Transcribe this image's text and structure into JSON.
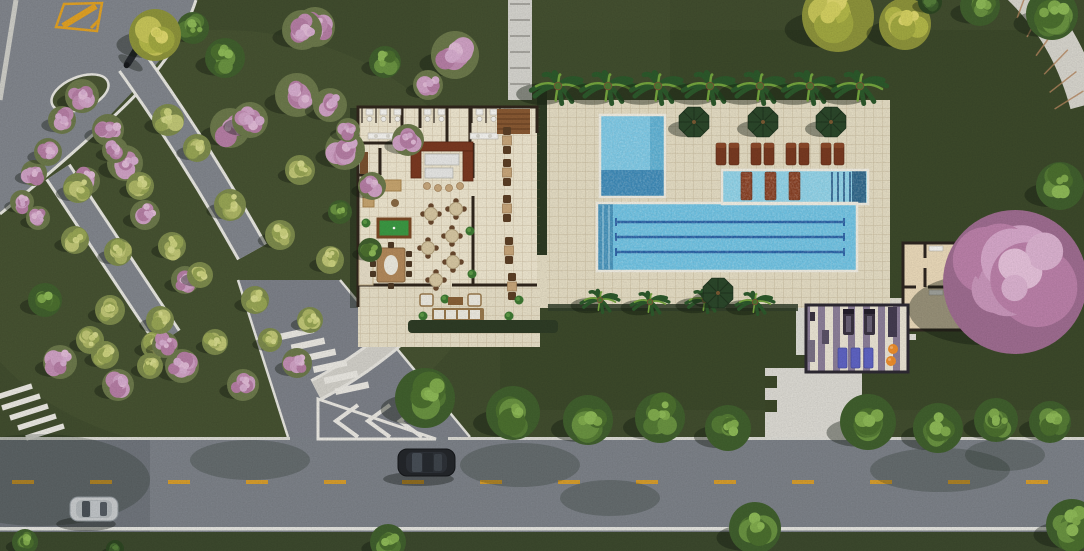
{
  "scene": {
    "description": "Aerial 3D-rendered site plan of a residential club amenity area: clubhouse with bar and games room, square children's pool, 3-lane lap pool with tanning shelf, fitness room, pool restrooms, palm-lined paver deck, flowering-tree grove with parking aisles, and a two-lane street with cars",
    "width": 1084,
    "height": 551
  },
  "areas": {
    "clubhouse": "clubhouse floor plan",
    "kids_pool": "children's pool",
    "lap_pool": "lap pool",
    "sun_shelf": "tanning shelf",
    "gym": "fitness room",
    "restrooms": "pool restrooms",
    "street": "two-lane street",
    "grove": "flowering tree grove"
  },
  "palette": {
    "grass": "#424e2f",
    "grass_dark": "#3c4829",
    "grass_light": "#4d5a37",
    "asphalt": "#7e838a",
    "curb": "#e9e8e2",
    "sidewalk": "#d7d6d0",
    "deck": "#e7dfc6",
    "floor": "#f0e8d1",
    "wall": "#31271d",
    "water": "#6fc4e5",
    "water_light": "#8fd4ea",
    "water_dark": "#3f8cba",
    "lane": "#2a63a8",
    "coping": "#f3f0e5",
    "umbrella": "#2c482b",
    "lounger": "#7a3b22",
    "hedge": "#2e3b24",
    "marking_yellow": "#dd9f28",
    "marking_white": "#eceae4",
    "gym_floor_a": "#ece6d6",
    "gym_floor_b": "#8e819b",
    "mat_blue": "#6065c6",
    "ball_orange": "#ef8f2d",
    "car_dark": "#24272b",
    "car_silver": "#c9ccce",
    "palm_dark": "#2d5a2c",
    "palm_light": "#76a73f",
    "pink_tree": "#d1a3c6",
    "yellow_tree": "#c9c75a",
    "green_tree": "#6b9442"
  },
  "trees": {
    "grove": [
      [
        "p",
        82,
        96,
        17
      ],
      [
        "p",
        62,
        120,
        14
      ],
      [
        "p",
        108,
        130,
        16
      ],
      [
        "p",
        125,
        163,
        18
      ],
      [
        "p",
        86,
        181,
        14
      ],
      [
        "p",
        34,
        173,
        13
      ],
      [
        "p",
        22,
        202,
        12
      ],
      [
        "p",
        230,
        128,
        20
      ],
      [
        "p",
        297,
        95,
        22
      ],
      [
        "p",
        345,
        150,
        20
      ],
      [
        "p",
        315,
        27,
        20
      ],
      [
        "p",
        48,
        152,
        14
      ],
      [
        "p",
        115,
        150,
        13
      ],
      [
        "p",
        145,
        215,
        15
      ],
      [
        "p",
        38,
        218,
        12
      ],
      [
        "p",
        185,
        280,
        14
      ],
      [
        "p",
        165,
        345,
        13
      ],
      [
        "p",
        408,
        140,
        16
      ],
      [
        "p",
        372,
        186,
        14
      ],
      [
        "p",
        455,
        55,
        24
      ],
      [
        "p",
        348,
        130,
        12
      ],
      [
        "p",
        250,
        120,
        18
      ],
      [
        "p",
        330,
        105,
        17
      ],
      [
        "p",
        302,
        30,
        20
      ],
      [
        "p",
        428,
        85,
        15
      ],
      [
        "yg",
        168,
        120,
        16
      ],
      [
        "yg",
        197,
        148,
        14
      ],
      [
        "yg",
        78,
        188,
        15
      ],
      [
        "yg",
        140,
        186,
        14
      ],
      [
        "yg",
        75,
        240,
        14
      ],
      [
        "yg",
        118,
        252,
        14
      ],
      [
        "yg",
        172,
        246,
        14
      ],
      [
        "yg",
        110,
        310,
        15
      ],
      [
        "yg",
        160,
        320,
        14
      ],
      [
        "yg",
        105,
        355,
        14
      ],
      [
        "yg",
        150,
        366,
        13
      ],
      [
        "yg",
        230,
        205,
        16
      ],
      [
        "yg",
        280,
        235,
        15
      ],
      [
        "yg",
        300,
        170,
        15
      ],
      [
        "yg",
        330,
        260,
        14
      ],
      [
        "yg",
        255,
        300,
        14
      ],
      [
        "yg",
        200,
        275,
        13
      ],
      [
        "yg",
        310,
        320,
        13
      ],
      [
        "g",
        225,
        58,
        20
      ],
      [
        "g",
        45,
        300,
        17
      ],
      [
        "g",
        193,
        28,
        16
      ],
      [
        "g",
        385,
        62,
        16
      ],
      [
        "g",
        340,
        212,
        12
      ],
      [
        "g",
        370,
        250,
        12
      ],
      [
        "y",
        155,
        35,
        26
      ]
    ],
    "road_row": [
      [
        "p",
        60,
        362,
        17
      ],
      [
        "yg",
        90,
        340,
        14
      ],
      [
        "p",
        118,
        385,
        16
      ],
      [
        "yg",
        155,
        345,
        14
      ],
      [
        "p",
        182,
        366,
        17
      ],
      [
        "yg",
        215,
        342,
        13
      ],
      [
        "p",
        243,
        385,
        16
      ],
      [
        "yg",
        270,
        340,
        12
      ],
      [
        "p",
        297,
        363,
        15
      ]
    ],
    "street": [
      [
        "g",
        425,
        398,
        30
      ],
      [
        "g",
        513,
        413,
        27
      ],
      [
        "g",
        588,
        420,
        25
      ],
      [
        "g",
        660,
        418,
        25
      ],
      [
        "g",
        728,
        428,
        23
      ],
      [
        "g",
        868,
        422,
        28
      ],
      [
        "g",
        938,
        428,
        25
      ],
      [
        "g",
        996,
        420,
        22
      ],
      [
        "g",
        1050,
        422,
        21
      ]
    ],
    "bottom": [
      [
        "g",
        388,
        542,
        18
      ],
      [
        "g",
        755,
        528,
        26
      ],
      [
        "g",
        1072,
        525,
        26
      ],
      [
        "g",
        25,
        542,
        13
      ],
      [
        "dg",
        115,
        549,
        9
      ]
    ],
    "top_right": [
      [
        "y",
        838,
        16,
        36
      ],
      [
        "y",
        905,
        24,
        26
      ],
      [
        "g",
        980,
        6,
        20
      ],
      [
        "g",
        1052,
        14,
        26
      ],
      [
        "g",
        1060,
        186,
        24
      ],
      [
        "dg",
        930,
        2,
        12
      ]
    ]
  },
  "big_pink_tree": {
    "x": 1015,
    "y": 282,
    "r": 72
  },
  "palms": {
    "top": {
      "y": 86,
      "size": 27,
      "xs": [
        558,
        608,
        658,
        710,
        760,
        810,
        860
      ]
    },
    "bottom": {
      "size": 19,
      "pts": [
        [
          600,
          300
        ],
        [
          650,
          302
        ],
        [
          705,
          300
        ],
        [
          755,
          302
        ]
      ]
    }
  },
  "pool": {
    "kids": {
      "x": 600,
      "y": 115,
      "w": 65,
      "h": 82
    },
    "lap": {
      "x": 597,
      "y": 203,
      "w": 260,
      "h": 68,
      "lanes": 3,
      "lane_ys": [
        222,
        237,
        252
      ],
      "lane_x1": 616,
      "lane_x2": 844
    },
    "shelf": {
      "x": 722,
      "y": 170,
      "w": 146,
      "h": 34
    },
    "shelf_loungers": [
      [
        741,
        172
      ],
      [
        765,
        172
      ],
      [
        789,
        172
      ]
    ],
    "steps_xs": [
      832,
      838,
      844,
      850
    ]
  },
  "deck": {
    "umbrellas": [
      [
        694,
        122
      ],
      [
        763,
        122
      ],
      [
        831,
        122
      ],
      [
        718,
        293
      ]
    ],
    "lounger_pairs": [
      [
        716,
        143
      ],
      [
        751,
        143
      ],
      [
        786,
        143
      ],
      [
        821,
        143
      ]
    ]
  },
  "clubhouse": {
    "round_tables": [
      [
        431,
        214
      ],
      [
        456,
        209
      ],
      [
        452,
        236
      ],
      [
        428,
        248
      ],
      [
        453,
        262
      ],
      [
        436,
        280
      ]
    ],
    "terrace_tables": [
      [
        507,
        140
      ],
      [
        507,
        172
      ],
      [
        507,
        208
      ],
      [
        509,
        250
      ],
      [
        512,
        286
      ]
    ],
    "bar_stools": [
      [
        427,
        186
      ],
      [
        438,
        188
      ],
      [
        449,
        188
      ],
      [
        460,
        186
      ]
    ],
    "plants": [
      [
        366,
        223
      ],
      [
        470,
        231
      ],
      [
        472,
        274
      ],
      [
        445,
        299
      ],
      [
        519,
        300
      ],
      [
        423,
        316
      ],
      [
        509,
        316
      ]
    ],
    "stall_xs": [
      366,
      380,
      394,
      424,
      438,
      476,
      490,
      504
    ],
    "sinks": [
      [
        368,
        133
      ],
      [
        470,
        133
      ]
    ]
  },
  "restrooms": {
    "toilets": [
      [
        958,
        248
      ],
      [
        958,
        260
      ],
      [
        958,
        272
      ],
      [
        958,
        292
      ],
      [
        958,
        304
      ],
      [
        958,
        316
      ]
    ],
    "sinks": [
      [
        929,
        246
      ],
      [
        929,
        290
      ]
    ]
  },
  "gym": {
    "treadmills": [
      [
        843,
        309
      ],
      [
        864,
        309
      ]
    ],
    "mats": [
      [
        838,
        348
      ],
      [
        851,
        348
      ],
      [
        864,
        348
      ]
    ],
    "balls": [
      [
        893,
        349
      ],
      [
        891,
        361
      ]
    ],
    "rack": [
      888,
      307
    ],
    "cabinet": [
      808,
      340
    ],
    "bench": [
      822,
      330
    ],
    "shelf": [
      810,
      312
    ]
  },
  "road": {
    "dashes": {
      "y": 480,
      "start": 12,
      "w": 22,
      "h": 4,
      "period": 78
    },
    "edge_line_y": 527,
    "curb_y": 437
  },
  "markings": {
    "yield": {
      "outline": "64,4 102,3 97,31 56,27",
      "band": [
        [
          63,
          26
        ],
        [
          96,
          6
        ]
      ],
      "tick": [
        [
          91,
          28
        ],
        [
          99,
          20
        ]
      ]
    },
    "zebra": {
      "n": 6,
      "x": 280,
      "y": 330,
      "dx": 11,
      "dy": 11,
      "w": 34,
      "h": 6.5,
      "rot": -12
    },
    "chevrons": {
      "xs": [
        345,
        377,
        409
      ],
      "y1": 405,
      "y2": 437,
      "depth": 22
    },
    "left_crosswalk": {
      "n": 5,
      "x": -6,
      "y": 398,
      "dx": 8,
      "dy": 10,
      "len": 38
    }
  },
  "path_ticks": [
    [
      1023,
      2,
      70
    ],
    [
      1035,
      22,
      62
    ],
    [
      1046,
      42,
      54
    ],
    [
      1056,
      62,
      46
    ],
    [
      1063,
      82,
      38
    ],
    [
      1069,
      100,
      32
    ]
  ],
  "cars": [
    {
      "type": "dark",
      "x": 398,
      "y": 449,
      "w": 57,
      "h": 27
    },
    {
      "type": "silver",
      "x": 70,
      "y": 497,
      "w": 48,
      "h": 24
    }
  ],
  "road_shadows": [
    [
      40,
      480,
      110,
      46
    ],
    [
      250,
      460,
      60,
      20
    ],
    [
      520,
      465,
      60,
      22
    ],
    [
      610,
      498,
      50,
      18
    ],
    [
      940,
      470,
      70,
      22
    ],
    [
      1005,
      455,
      40,
      16
    ]
  ]
}
